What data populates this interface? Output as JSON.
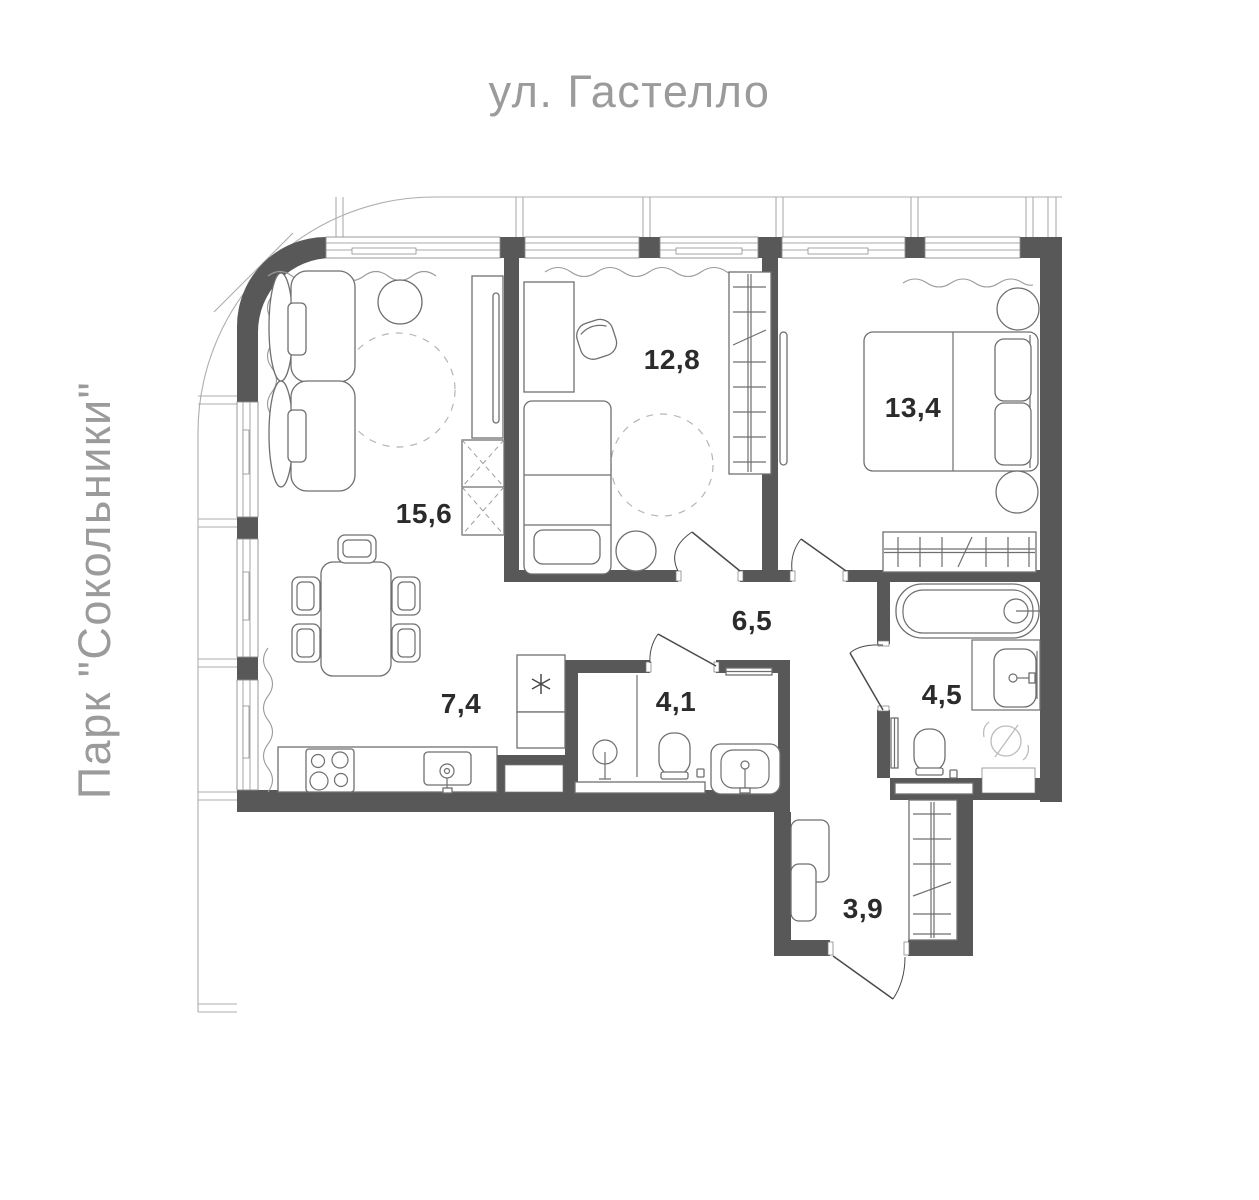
{
  "page": {
    "top_label": "ул. Гастелло",
    "left_label": "Парк \"Сокольники\"",
    "label_color": "#9b9b9b",
    "background": "#ffffff"
  },
  "plan": {
    "wall_color": "#585858",
    "furniture_line_color": "#6f6f6f",
    "facade_line_color": "#adadad",
    "area_label_color": "#2b2b2b",
    "area_unit": "",
    "rooms": [
      {
        "id": "living-room",
        "area": "15,6"
      },
      {
        "id": "kitchen",
        "area": "7,4"
      },
      {
        "id": "bedroom-small",
        "area": "12,8"
      },
      {
        "id": "bedroom-master",
        "area": "13,4"
      },
      {
        "id": "hallway",
        "area": "6,5"
      },
      {
        "id": "bathroom-shower",
        "area": "4,1"
      },
      {
        "id": "bathroom-tub",
        "area": "4,5"
      },
      {
        "id": "entry-hall",
        "area": "3,9"
      }
    ]
  }
}
